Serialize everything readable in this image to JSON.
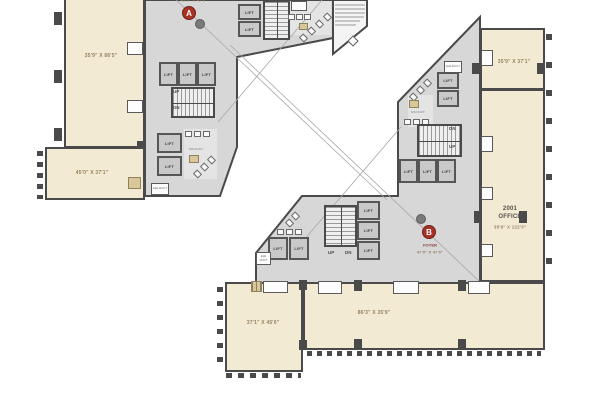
{
  "title": "Floor plan with two tower cores",
  "colors": {
    "office_fill": "#f3ead3",
    "core_fill": "#d7d7d7",
    "wall": "#4a4a4a",
    "marker_red": "#a93226",
    "dim_text": "#95825f",
    "foyer_text": "#8a3f2f"
  },
  "tower_a": {
    "marker": "A",
    "foyer": {
      "dims": "47'0\" X 47'0\""
    },
    "rooms": [
      {
        "dims": "35'9\" X 86'5\""
      },
      {
        "dims": "45'0\" X 37'1\""
      }
    ]
  },
  "tower_b": {
    "marker": "B",
    "foyer": {
      "label": "FOYER",
      "dims": "47'0\" X 47'0\""
    },
    "rooms": [
      {
        "dims": "35'9\" X 37'1\""
      },
      {
        "number": "2001",
        "name": "OFFICE",
        "dims": "35'9\" X 122'3\""
      },
      {
        "dims": "86'3\" X 35'9\""
      },
      {
        "dims": "37'1\" X 45'0\""
      }
    ]
  },
  "labels": {
    "lift": "LIFT",
    "up": "UP",
    "dn": "DN",
    "ele_duct": "ELE DUCT",
    "ms_duct": "MS DUCT"
  }
}
